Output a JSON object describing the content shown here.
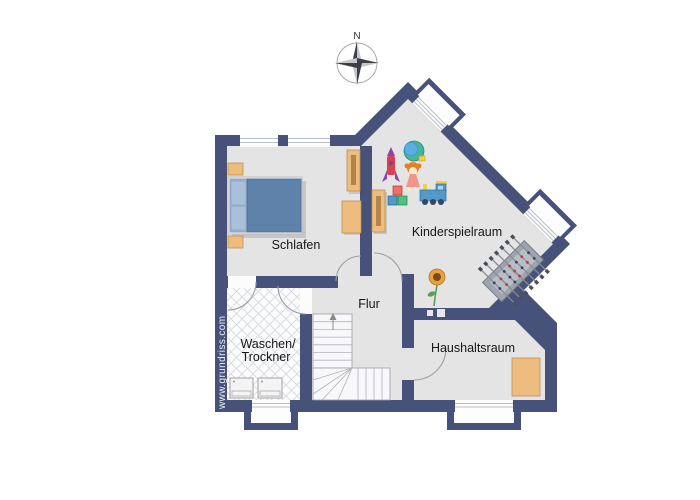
{
  "compass": {
    "label": "N"
  },
  "watermark": {
    "text": "www.grundriss.com"
  },
  "rooms": {
    "schlafen": {
      "label": "Schlafen"
    },
    "kinderspielraum": {
      "label": "Kinderspielraum"
    },
    "flur": {
      "label": "Flur"
    },
    "waschen": {
      "label_line1": "Waschen/",
      "label_line2": "Trockner"
    },
    "haushaltsraum": {
      "label": "Haushaltsraum"
    }
  },
  "icons": {
    "compass": "compass-rose-icon",
    "bed": "double-bed-icon",
    "wardrobe": "wardrobe-icon",
    "desk": "desk-icon",
    "washer": "washing-machine-icon",
    "dryer": "dryer-icon",
    "stairs": "staircase-icon",
    "foosball": "foosball-table-icon",
    "rocket": "toy-rocket-icon",
    "drum": "toy-drum-icon",
    "doll": "toy-doll-icon",
    "blocks": "toy-blocks-icon",
    "train": "toy-train-icon",
    "sunflower": "sunflower-icon"
  },
  "colors": {
    "background": "#ffffff",
    "wall": "#47527b",
    "floor": "#e4e4e5",
    "tile_floor": "#fcfcfd",
    "tile_line": "#d9dbe3",
    "furniture": "#edbd80",
    "furniture_border": "#c08f50",
    "bed_duvet": "#5f82ab",
    "bed_pillow": "#9ab3d2",
    "label_text": "#161616",
    "watermark_text": "#eef0f5"
  }
}
